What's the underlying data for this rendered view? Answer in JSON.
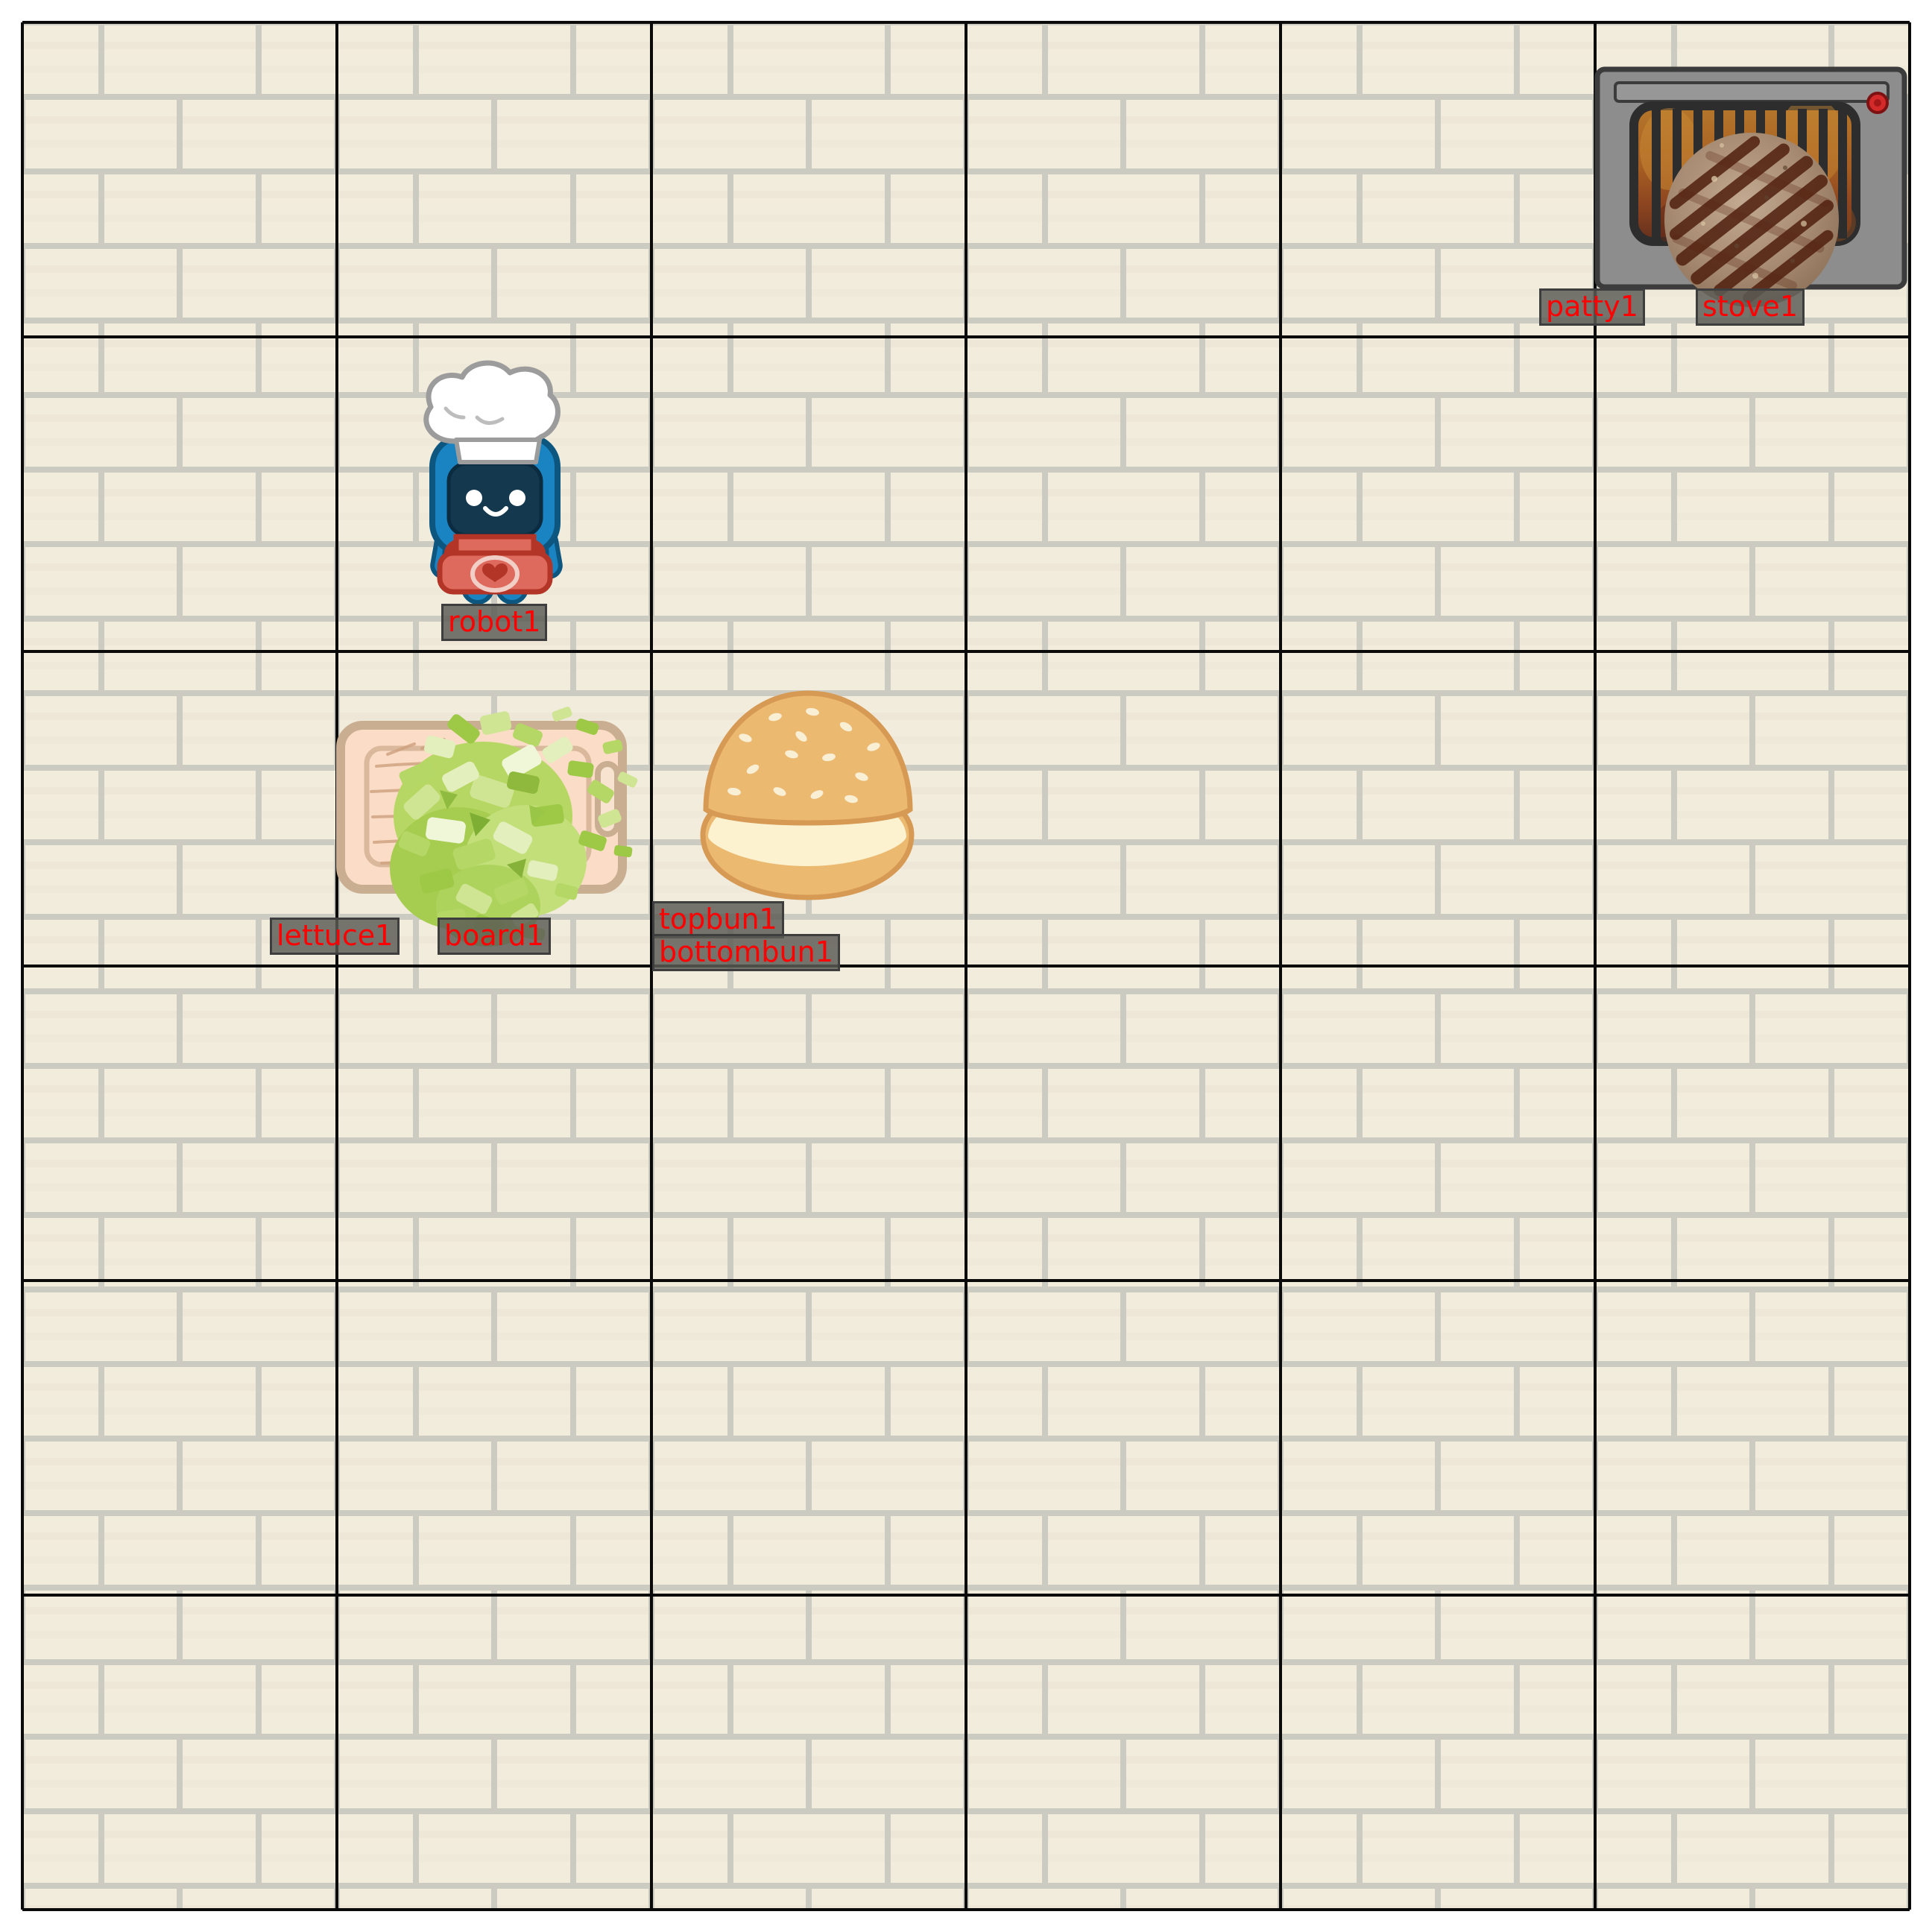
{
  "scene": {
    "name": "kitchen-gridworld",
    "grid": {
      "rows": 6,
      "cols": 6
    },
    "background": "cream-brick-wall"
  },
  "labels": {
    "patty": "patty1",
    "stove": "stove1",
    "robot": "robot1",
    "lettuce": "lettuce1",
    "board": "board1",
    "topbun": "topbun1",
    "bottombun": "bottombun1"
  },
  "entities": [
    {
      "id": "stove1",
      "type": "stove",
      "cell": {
        "row": 1,
        "col": 6
      }
    },
    {
      "id": "patty1",
      "type": "burger-patty",
      "cell": {
        "row": 1,
        "col": 6
      },
      "state": "on-stove"
    },
    {
      "id": "robot1",
      "type": "robot-chef",
      "cell": {
        "row": 2,
        "col": 2
      }
    },
    {
      "id": "board1",
      "type": "cutting-board",
      "cell": {
        "row": 3,
        "col": 2
      }
    },
    {
      "id": "lettuce1",
      "type": "chopped-lettuce",
      "cell": {
        "row": 3,
        "col": 2
      },
      "state": "on-board"
    },
    {
      "id": "topbun1",
      "type": "top-bun",
      "cell": {
        "row": 3,
        "col": 3
      }
    },
    {
      "id": "bottombun1",
      "type": "bottom-bun",
      "cell": {
        "row": 3,
        "col": 3
      }
    }
  ],
  "colors": {
    "label_text": "#ff0000",
    "label_bg": "#5c5c56",
    "label_border": "#3e3e3e",
    "grid_line": "#0a0a0a",
    "brick": "#f2ecdd",
    "mortar": "#cbcbc1",
    "robot_blue": "#1a84c2",
    "apron_red": "#dd6a5c",
    "stove_gray": "#8d8d8d",
    "bun_gold": "#ecb971",
    "lettuce_green": "#b7d765"
  }
}
